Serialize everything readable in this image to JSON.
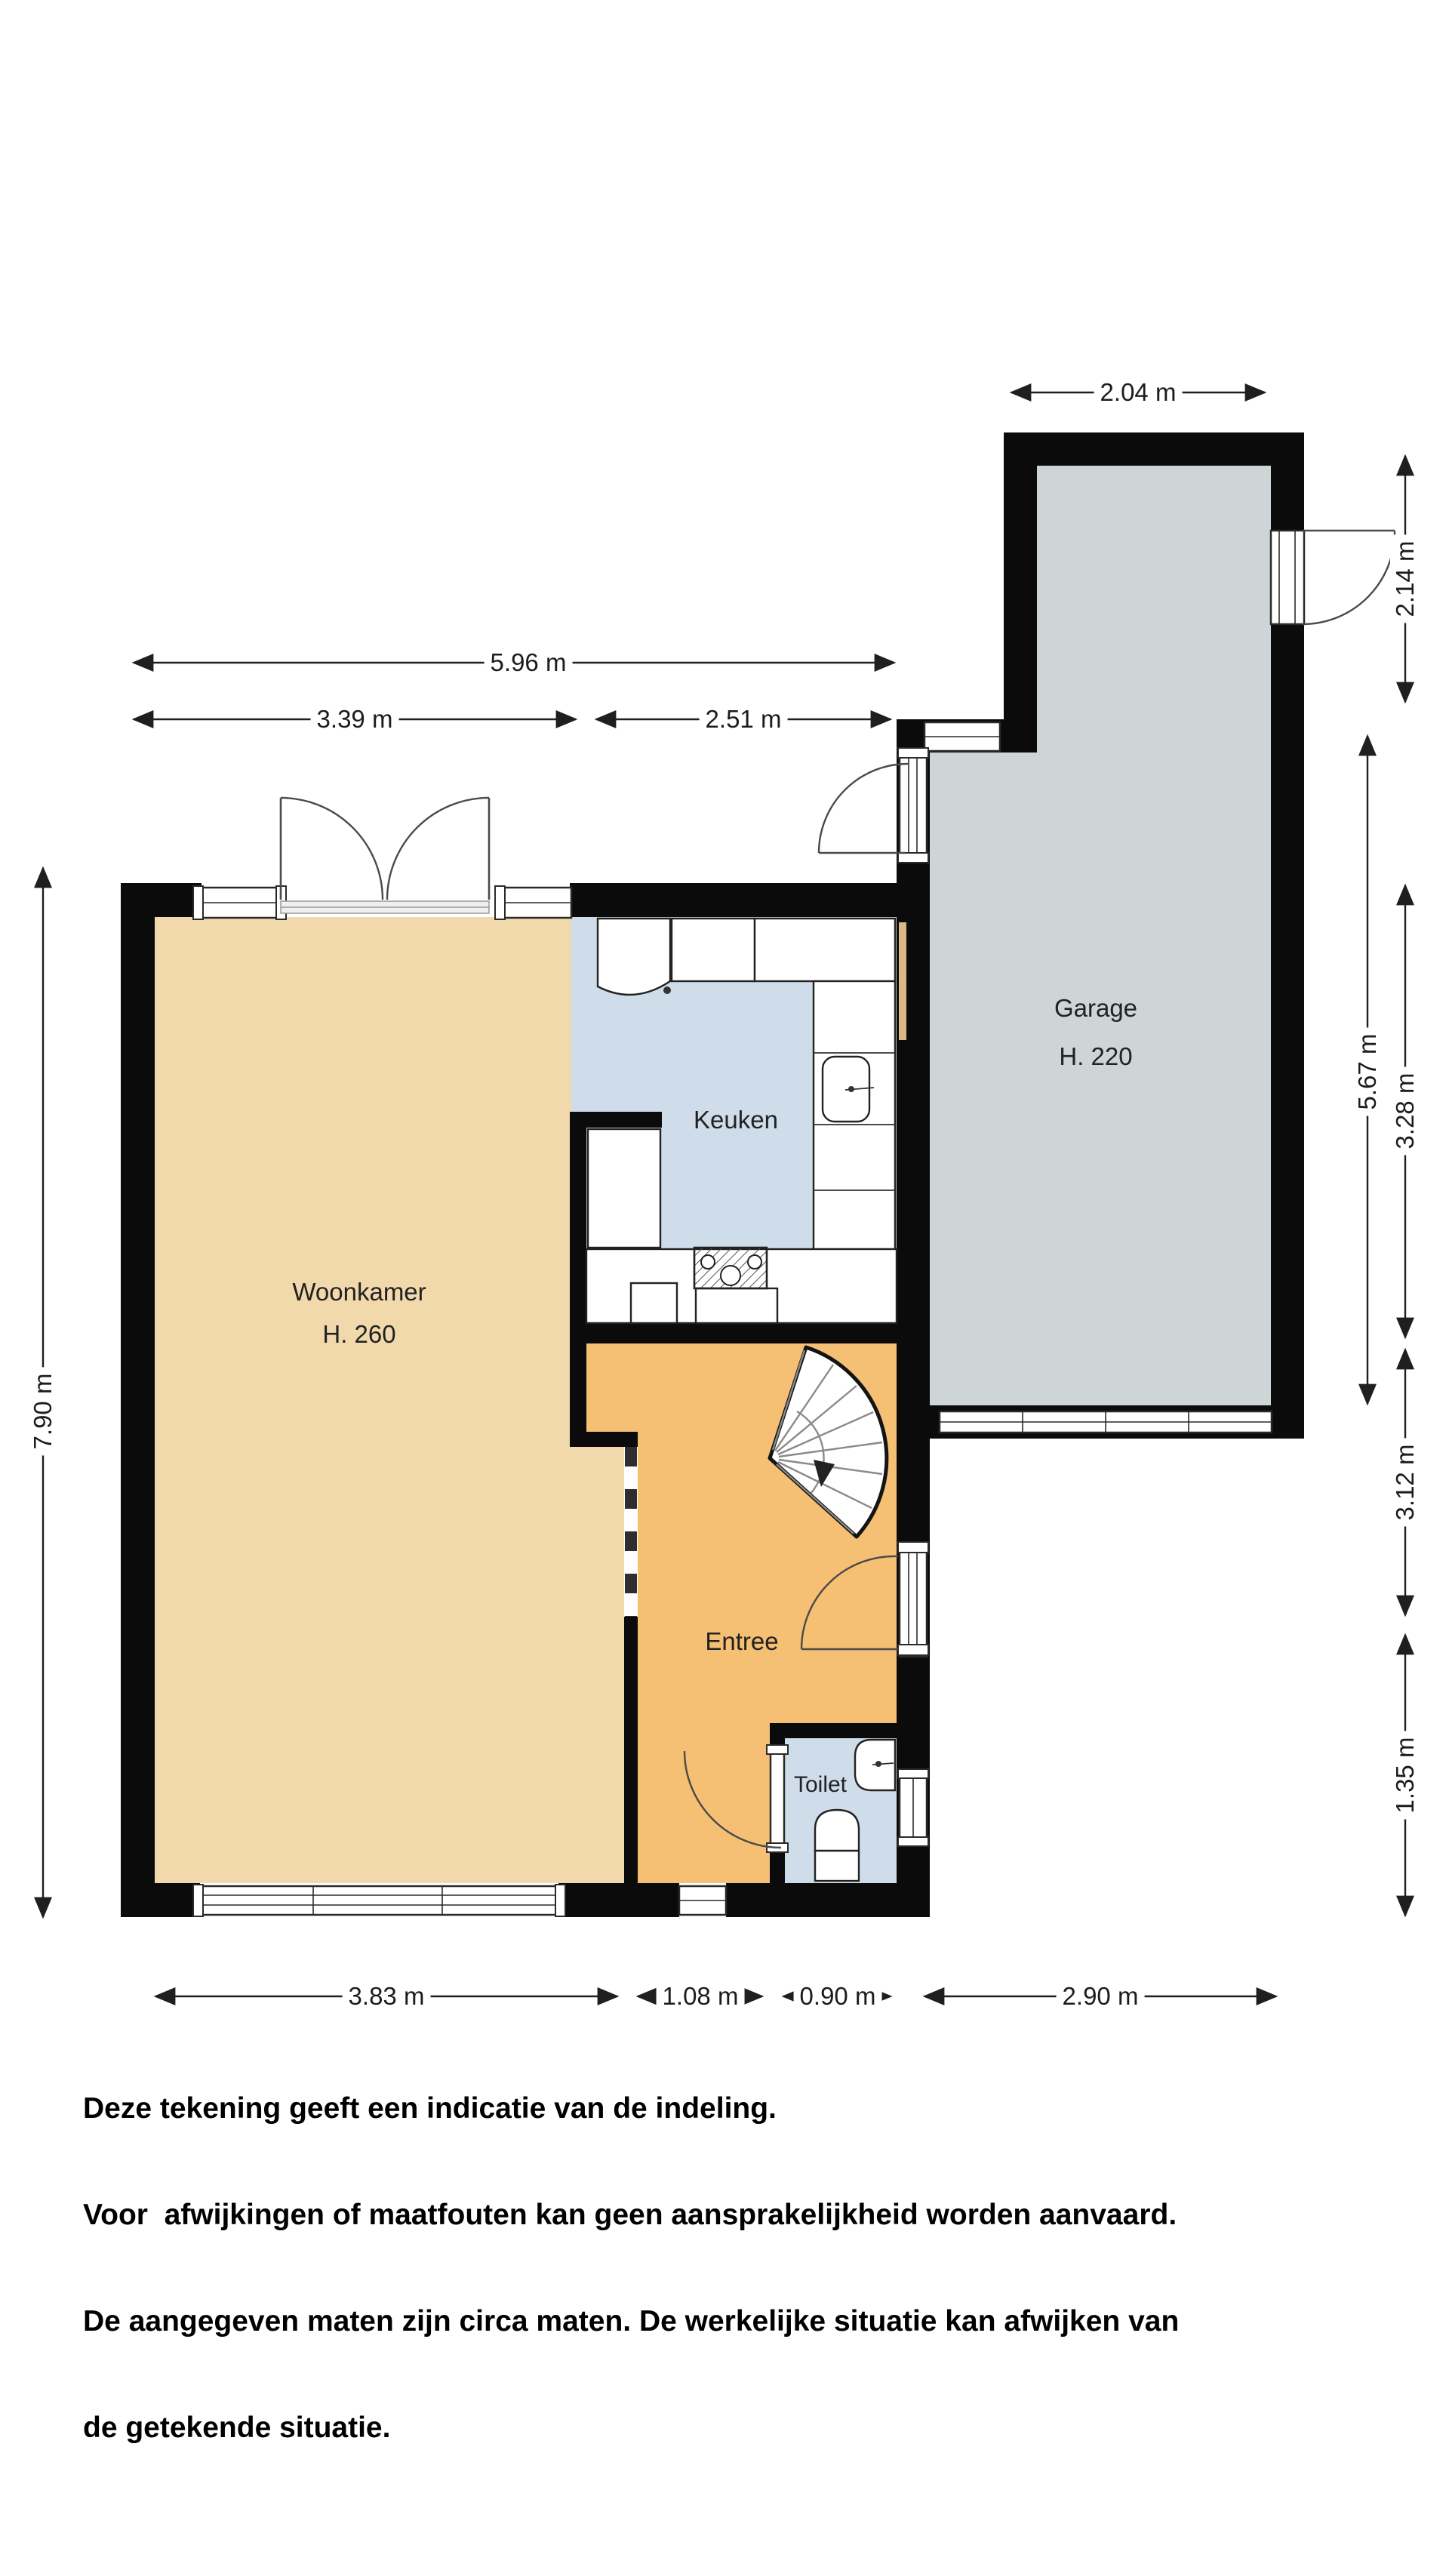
{
  "rooms": {
    "woonkamer": {
      "name": "Woonkamer",
      "height": "H. 260"
    },
    "keuken": {
      "name": "Keuken"
    },
    "garage": {
      "name": "Garage",
      "height": "H. 220"
    },
    "entree": {
      "name": "Entree"
    },
    "toilet": {
      "name": "Toilet"
    }
  },
  "dimensions": {
    "garage_top": "2.04 m",
    "top_total": "5.96 m",
    "top_left": "3.39 m",
    "top_right": "2.51 m",
    "left_total": "7.90 m",
    "right_upper": "2.14 m",
    "right_garage": "5.67 m",
    "right_a": "3.28 m",
    "right_b": "3.12 m",
    "right_c": "1.35 m",
    "bottom_1": "3.83 m",
    "bottom_2": "1.08 m",
    "bottom_3": "0.90 m",
    "bottom_4": "2.90 m"
  },
  "disclaimer": {
    "line1": "Deze tekening geeft een indicatie van de indeling.",
    "line2": "Voor  afwijkingen of maatfouten kan geen aansprakelijkheid worden aanvaard.",
    "line3": "De aangegeven maten zijn circa maten. De werkelijke situatie kan afwijken van",
    "line4": "de getekende situatie."
  },
  "colors": {
    "woonkamer": "#F1D9AC",
    "entree": "#F5BF74",
    "keuken": "#CFDDEB",
    "toilet": "#CFDDEB",
    "garage": "#CDD5D6",
    "wall": "#0B0B0B",
    "door": "#DCB887"
  }
}
